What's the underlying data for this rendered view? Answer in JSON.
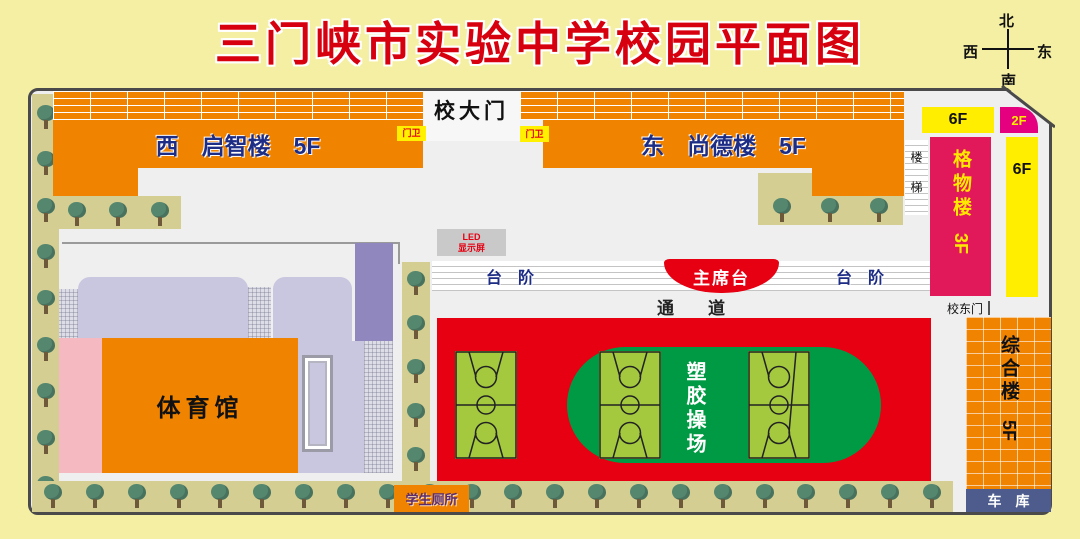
{
  "title": {
    "text": "三门峡市实验中学校园平面图",
    "color": "#D7000F"
  },
  "compass": {
    "north": "北",
    "south": "南",
    "west": "西",
    "east": "东"
  },
  "map": {
    "gate_label": "校大门",
    "guard_left": "门卫",
    "guard_right": "门卫",
    "west_building": {
      "label": "西　启智楼　5F",
      "floors": "5F"
    },
    "east_building": {
      "label": "东　尚德楼　5F",
      "floors": "5F"
    },
    "stairs_label": "楼梯",
    "right_wing": {
      "six_f_top": "6F",
      "two_f": "2F",
      "six_f_side": "6F",
      "gewu": {
        "name": "格物楼",
        "floors": "3F"
      },
      "east_gate": "校东门",
      "zonghe": {
        "name": "综合楼",
        "floors": "5F"
      },
      "garage": "车　库"
    },
    "led": {
      "line1": "LED",
      "line2": "显示屏"
    },
    "steps_left": "台　阶",
    "steps_right": "台　阶",
    "rostrum": "主席台",
    "passage": "通　　道",
    "playground": {
      "label": "塑胶操场"
    },
    "gym": {
      "label": "体育馆"
    },
    "toilet": "学生厕所"
  },
  "colors": {
    "page_bg": "#F4EFA3",
    "building_orange": "#F08300",
    "track_red": "#E60012",
    "field_green": "#009A44",
    "court_green": "#A4C93F",
    "gewu_crimson": "#E1195B",
    "magenta_2f": "#E4007F",
    "bar_yellow": "#FFEE00",
    "garage_slate": "#4D5C8C",
    "label_navy": "#1D2C85",
    "lavender": "#C9C6DF",
    "purple": "#8F87BE",
    "pink": "#F5B9C2",
    "tree_strip_tan": "#D5CE92",
    "title_red": "#D7000F"
  }
}
